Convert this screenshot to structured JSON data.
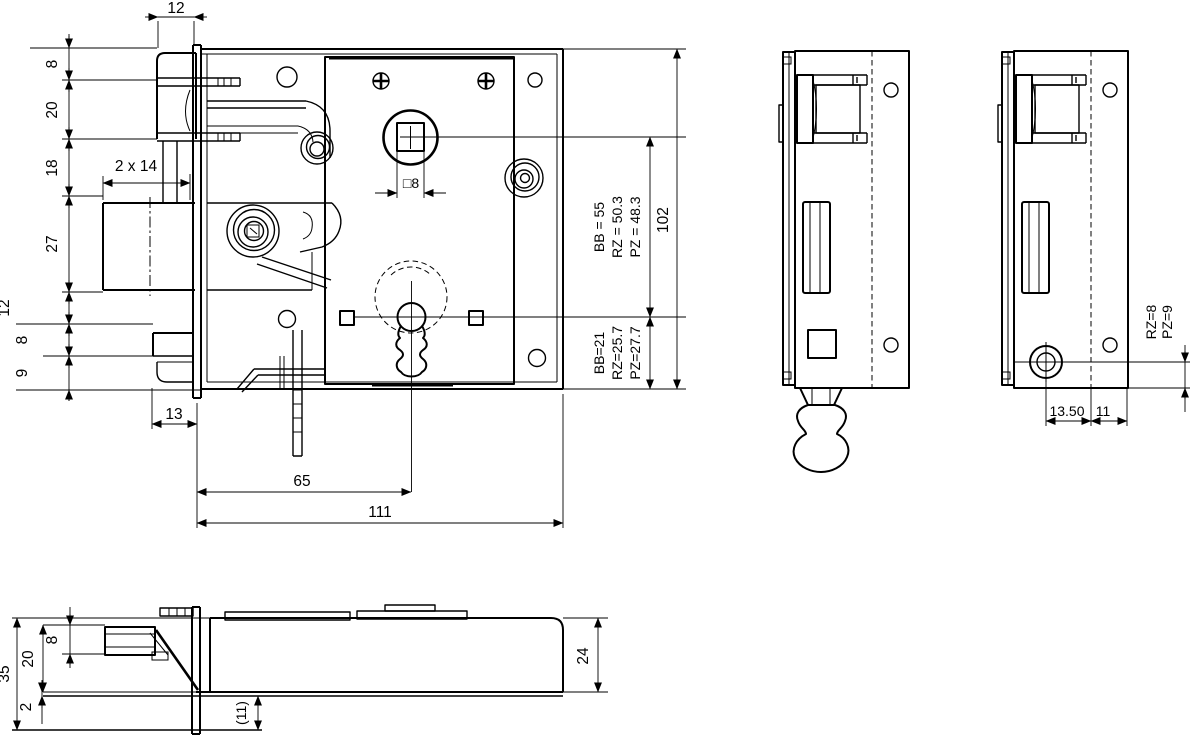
{
  "colors": {
    "line": "#000000",
    "background": "#ffffff"
  },
  "front_view": {
    "top_dim": "12",
    "left_dims": [
      "8",
      "20",
      "18",
      "27",
      "12",
      "8",
      "9"
    ],
    "bolt_throw_dim": "2 x 14",
    "follower_square_dim": "□8",
    "dim_13": "13",
    "dim_65": "65",
    "dim_111": "111",
    "dim_102": "102",
    "distance_upper": [
      "BB = 55",
      "RZ = 50.3",
      "PZ = 48.3"
    ],
    "distance_lower": [
      "BB=21",
      "RZ=25.7",
      "PZ=27.7"
    ]
  },
  "side_view_right": {
    "dim_1350": "13.50",
    "dim_11": "11",
    "distance": [
      "RZ=8",
      "PZ=9"
    ]
  },
  "bottom_view": {
    "dim_35": "35",
    "dim_20": "20",
    "dim_8": "8",
    "dim_2": "2",
    "dim_11_ref": "(11)",
    "dim_24": "24"
  }
}
